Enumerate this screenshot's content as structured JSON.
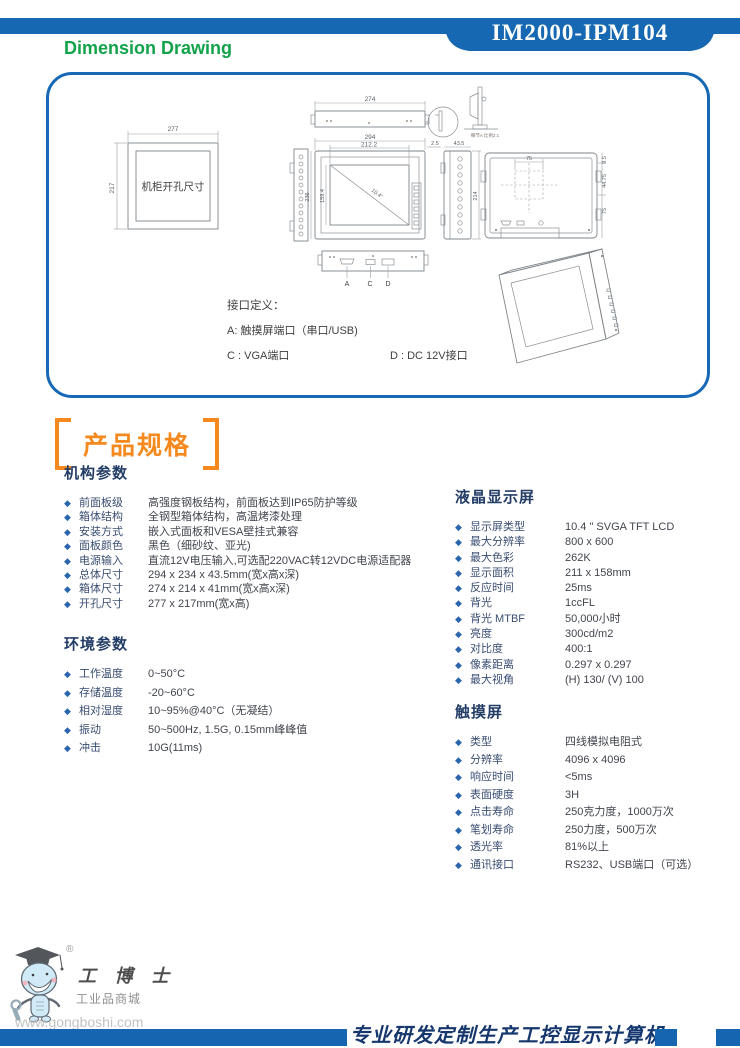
{
  "header": {
    "model": "IM2000-IPM104",
    "section_title": "Dimension Drawing"
  },
  "colors": {
    "accent_blue": "#1568b1",
    "title_green": "#12a24a",
    "spec_orange": "#f5891d",
    "heading_navy": "#233d66",
    "footer_blue": "#1565b0"
  },
  "drawing": {
    "cutout_label": "机柜开孔尺寸",
    "detail_note": "细节A 比例2:1",
    "dims": {
      "cutout_width": "277",
      "cutout_height": "217",
      "top_width": "274",
      "overall_width": "294",
      "screen_width": "212.2",
      "overall_height": "236",
      "screen_height": "159.4",
      "diagonal": "10.4\"",
      "side_gap": "2.5",
      "side_depth": "43.5",
      "side_height": "214",
      "vesa_width": "75",
      "rear_offset": "9.5",
      "rear_mid": "44.75",
      "vesa_height": "75"
    },
    "ports": [
      "A",
      "C",
      "D"
    ],
    "interface": {
      "title": "接口定义：",
      "item_a": "A: 触摸屏端口（串口/USB)",
      "item_c": "C : VGA端口",
      "item_d": "D : DC 12V接口"
    }
  },
  "specs": {
    "title": "产品规格",
    "left": [
      {
        "name": "机构参数",
        "items": [
          {
            "label": "前面板级",
            "value": "高强度钢板结构，前面板达到IP65防护等级"
          },
          {
            "label": "箱体结构",
            "value": "全钢型箱体结构，高温烤漆处理"
          },
          {
            "label": "安装方式",
            "value": "嵌入式面板和VESA壁挂式兼容"
          },
          {
            "label": "面板颜色",
            "value": "黑色（细砂纹、亚光)"
          },
          {
            "label": "电源输入",
            "value": "直流12V电压输入,可选配220VAC转12VDC电源适配器"
          },
          {
            "label": "总体尺寸",
            "value": "294 x 234 x 43.5mm(宽x高x深)"
          },
          {
            "label": "箱体尺寸",
            "value": "274 x 214 x 41mm(宽x高x深)"
          },
          {
            "label": "开孔尺寸",
            "value": "277 x 217mm(宽x高)"
          }
        ]
      },
      {
        "name": "环境参数",
        "items": [
          {
            "label": "工作温度",
            "value": "0~50°C"
          },
          {
            "label": "存储温度",
            "value": "-20~60°C"
          },
          {
            "label": "相对湿度",
            "value": "10~95%@40°C（无凝结）"
          },
          {
            "label": "振动",
            "value": "50~500Hz, 1.5G, 0.15mm峰峰值"
          },
          {
            "label": "冲击",
            "value": "10G(11ms)"
          }
        ]
      }
    ],
    "right": [
      {
        "name": "液晶显示屏",
        "items": [
          {
            "label": "显示屏类型",
            "value": "10.4 \" SVGA TFT LCD"
          },
          {
            "label": "最大分辨率",
            "value": "800 x 600"
          },
          {
            "label": "最大色彩",
            "value": "262K"
          },
          {
            "label": "显示面积",
            "value": "211 x 158mm"
          },
          {
            "label": "反应时间",
            "value": "25ms"
          },
          {
            "label": "背光",
            "value": "1ccFL"
          },
          {
            "label": "背光 MTBF",
            "value": "50,000小时"
          },
          {
            "label": "亮度",
            "value": "300cd/m2"
          },
          {
            "label": "对比度",
            "value": "400:1"
          },
          {
            "label": "像素距离",
            "value": "0.297 x 0.297"
          },
          {
            "label": "最大视角",
            "value": "(H) 130/ (V) 100"
          }
        ]
      },
      {
        "name": "触摸屏",
        "items": [
          {
            "label": "类型",
            "value": "四线模拟电阻式"
          },
          {
            "label": "分辨率",
            "value": "4096 x 4096"
          },
          {
            "label": "响应时间",
            "value": "<5ms"
          },
          {
            "label": "表面硬度",
            "value": "3H"
          },
          {
            "label": "点击寿命",
            "value": "250克力度，1000万次"
          },
          {
            "label": "笔划寿命",
            "value": "250力度，500万次"
          },
          {
            "label": "透光率",
            "value": "81%以上"
          },
          {
            "label": "通讯接口",
            "value": "RS232、USB端口（可选）"
          }
        ]
      }
    ]
  },
  "watermark": {
    "registered": "®",
    "brand": "工 博 士",
    "subtitle": "工业品商城",
    "url": "www.gongboshi.com"
  },
  "footer": {
    "slogan": "专业研发定制生产工控显示计算机"
  }
}
